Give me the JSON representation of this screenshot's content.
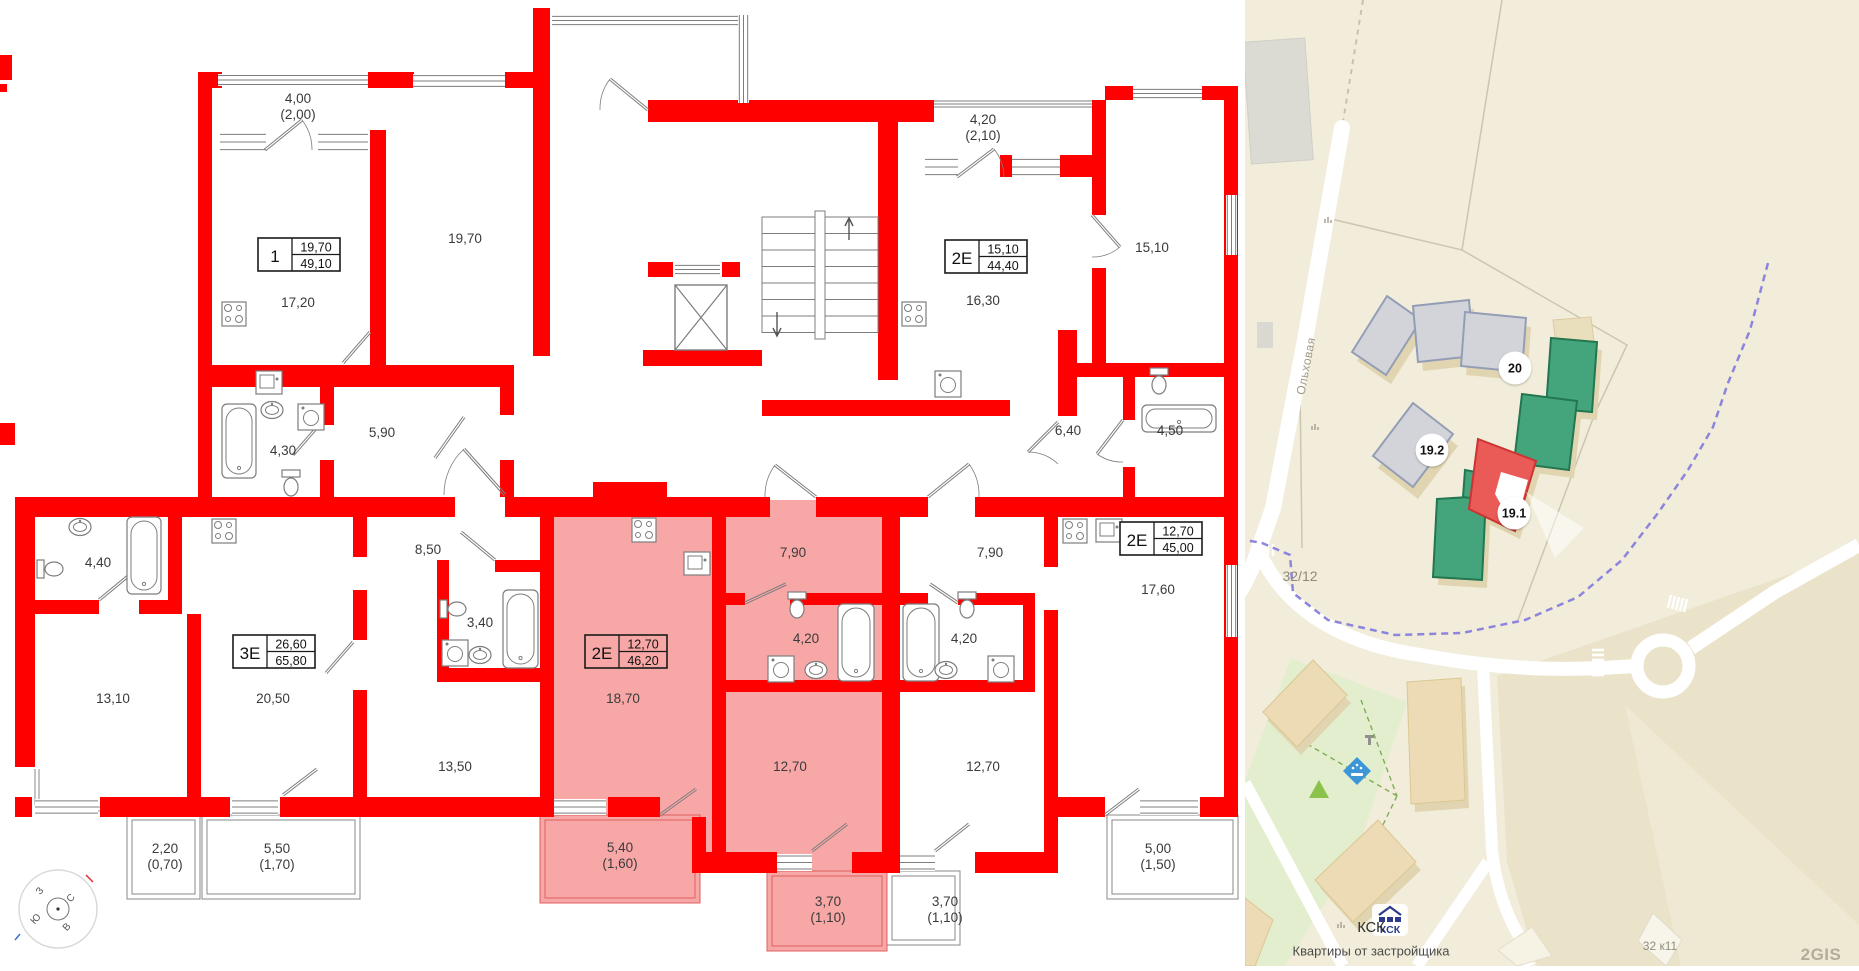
{
  "floorplan": {
    "colors": {
      "wall": "#ff0000",
      "highlight": "#f8a7a7",
      "line": "#7d7d7d",
      "text": "#3a3a3a",
      "balcony_hl_line": "#e05f5f"
    },
    "rooms": [
      {
        "label": "4,00",
        "sub": "(2,00)",
        "x": 298,
        "y": 103
      },
      {
        "label": "19,70",
        "sub": "",
        "x": 465,
        "y": 243
      },
      {
        "label": "17,20",
        "sub": "",
        "x": 298,
        "y": 307
      },
      {
        "label": "4,30",
        "sub": "",
        "x": 283,
        "y": 455
      },
      {
        "label": "5,90",
        "sub": "",
        "x": 382,
        "y": 437
      },
      {
        "label": "4,20",
        "sub": "(2,10)",
        "x": 983,
        "y": 124
      },
      {
        "label": "15,10",
        "sub": "",
        "x": 1152,
        "y": 252
      },
      {
        "label": "16,30",
        "sub": "",
        "x": 983,
        "y": 305
      },
      {
        "label": "6,40",
        "sub": "",
        "x": 1068,
        "y": 435
      },
      {
        "label": "4,50",
        "sub": "",
        "x": 1170,
        "y": 435
      },
      {
        "label": "4,40",
        "sub": "",
        "x": 98,
        "y": 567
      },
      {
        "label": "8,50",
        "sub": "",
        "x": 428,
        "y": 554
      },
      {
        "label": "3,40",
        "sub": "",
        "x": 480,
        "y": 627
      },
      {
        "label": "13,10",
        "sub": "",
        "x": 113,
        "y": 703
      },
      {
        "label": "20,50",
        "sub": "",
        "x": 273,
        "y": 703
      },
      {
        "label": "13,50",
        "sub": "",
        "x": 455,
        "y": 771
      },
      {
        "label": "2,20",
        "sub": "(0,70)",
        "x": 165,
        "y": 853
      },
      {
        "label": "5,50",
        "sub": "(1,70)",
        "x": 277,
        "y": 853
      },
      {
        "label": "18,70",
        "sub": "",
        "x": 623,
        "y": 703
      },
      {
        "label": "7,90",
        "sub": "",
        "x": 793,
        "y": 557
      },
      {
        "label": "4,20",
        "sub": "",
        "x": 806,
        "y": 643
      },
      {
        "label": "12,70",
        "sub": "",
        "x": 790,
        "y": 771
      },
      {
        "label": "5,40",
        "sub": "(1,60)",
        "x": 620,
        "y": 852
      },
      {
        "label": "3,70",
        "sub": "(1,10)",
        "x": 828,
        "y": 906
      },
      {
        "label": "3,70",
        "sub": "(1,10)",
        "x": 945,
        "y": 906
      },
      {
        "label": "7,90",
        "sub": "",
        "x": 990,
        "y": 557
      },
      {
        "label": "4,20",
        "sub": "",
        "x": 964,
        "y": 643
      },
      {
        "label": "12,70",
        "sub": "",
        "x": 983,
        "y": 771
      },
      {
        "label": "17,60",
        "sub": "",
        "x": 1158,
        "y": 594
      },
      {
        "label": "5,00",
        "sub": "(1,50)",
        "x": 1158,
        "y": 853
      }
    ],
    "apartments": [
      {
        "type": "1",
        "value_top": "19,70",
        "value_bottom": "49,10",
        "x": 258,
        "y": 238,
        "highlighted": false
      },
      {
        "type": "2Е",
        "value_top": "15,10",
        "value_bottom": "44,40",
        "x": 945,
        "y": 240,
        "highlighted": false
      },
      {
        "type": "3Е",
        "value_top": "26,60",
        "value_bottom": "65,80",
        "x": 233,
        "y": 635,
        "highlighted": false
      },
      {
        "type": "2Е",
        "value_top": "12,70",
        "value_bottom": "46,20",
        "x": 585,
        "y": 635,
        "highlighted": true
      },
      {
        "type": "2Е",
        "value_top": "12,70",
        "value_bottom": "45,00",
        "x": 1120,
        "y": 522,
        "highlighted": false
      }
    ],
    "compass_letters": [
      {
        "ch": "З",
        "x": 42,
        "y": 893
      },
      {
        "ch": "С",
        "x": 73,
        "y": 900
      },
      {
        "ch": "Ю",
        "x": 38,
        "y": 921
      },
      {
        "ch": "В",
        "x": 69,
        "y": 929
      }
    ]
  },
  "map": {
    "street": "Ольховая",
    "parcel_label": "32/12",
    "corner_building_label": "32 к11",
    "badges": [
      {
        "label": "20",
        "x": 270,
        "y": 368
      },
      {
        "label": "19.2",
        "x": 187,
        "y": 450
      },
      {
        "label": "19.1",
        "x": 269,
        "y": 513
      }
    ],
    "developer": {
      "logo_text": "КСК",
      "name": "КСК",
      "tagline": "Квартиры от застройщика"
    },
    "watermark": "2GIS"
  }
}
